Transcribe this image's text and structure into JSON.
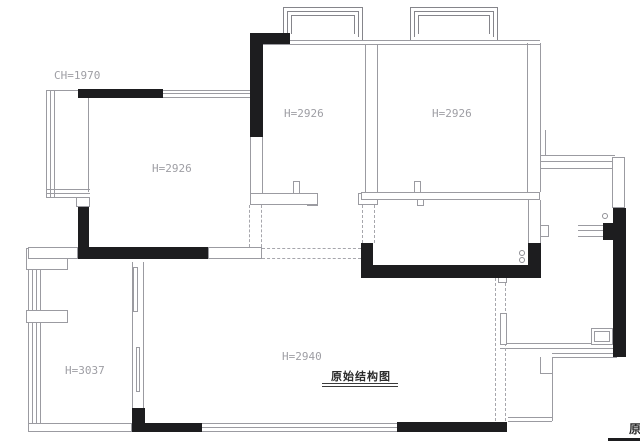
{
  "drawing": {
    "title": {
      "text": "原始结构图"
    },
    "clipped_title": {
      "text": "原"
    },
    "height_labels": [
      {
        "text": "CH=1970",
        "x": 54,
        "y": 69
      },
      {
        "text": "H=2926",
        "x": 152,
        "y": 162
      },
      {
        "text": "H=2926",
        "x": 284,
        "y": 107
      },
      {
        "text": "H=2926",
        "x": 432,
        "y": 107
      },
      {
        "text": "H=3037",
        "x": 65,
        "y": 364
      },
      {
        "text": "H=2940",
        "x": 282,
        "y": 350
      }
    ],
    "colors": {
      "wall_fill": "#1d1d1f",
      "thin_line": "#9b9ba1",
      "dashed_line": "#a6a6ac",
      "label_text": "#9e9ea4",
      "title_text": "#2b2b2b"
    }
  },
  "geometry": {
    "black_rects": [
      {
        "n": "wall-top-left",
        "x": 78,
        "y": 89,
        "w": 85,
        "h": 9
      },
      {
        "n": "wall-left-vertical",
        "x": 78,
        "y": 207,
        "w": 11,
        "h": 52
      },
      {
        "n": "wall-living-bottom",
        "x": 78,
        "y": 247,
        "w": 130,
        "h": 12
      },
      {
        "n": "wall-bed2-top",
        "x": 250,
        "y": 33,
        "w": 40,
        "h": 11
      },
      {
        "n": "wall-bed2-left",
        "x": 250,
        "y": 33,
        "w": 13,
        "h": 104
      },
      {
        "n": "wall-kitchen-left",
        "x": 361,
        "y": 243,
        "w": 12,
        "h": 35
      },
      {
        "n": "wall-kitchen-bottom",
        "x": 361,
        "y": 265,
        "w": 180,
        "h": 13
      },
      {
        "n": "wall-kitchen-right",
        "x": 528,
        "y": 243,
        "w": 13,
        "h": 35
      },
      {
        "n": "wall-right-exterior",
        "x": 613,
        "y": 208,
        "w": 13,
        "h": 149
      },
      {
        "n": "wall-right-corner",
        "x": 603,
        "y": 223,
        "w": 12,
        "h": 17
      },
      {
        "n": "wall-bottom-left-vertical",
        "x": 132,
        "y": 408,
        "w": 13,
        "h": 24
      },
      {
        "n": "wall-bottom-left",
        "x": 132,
        "y": 423,
        "w": 70,
        "h": 9
      },
      {
        "n": "wall-bottom-right",
        "x": 397,
        "y": 422,
        "w": 110,
        "h": 10
      }
    ],
    "outline_rects": [
      {
        "n": "opening-living-bottom",
        "x": 208,
        "y": 247,
        "w": 54,
        "h": 12
      },
      {
        "n": "wall-segment-left",
        "x": 76,
        "y": 197,
        "w": 14,
        "h": 10
      },
      {
        "n": "fixture-left-upper",
        "x": 26,
        "y": 248,
        "w": 42,
        "h": 22
      },
      {
        "n": "fixture-left-lower",
        "x": 26,
        "y": 310,
        "w": 42,
        "h": 13
      },
      {
        "n": "entry-door-leaf",
        "x": 591,
        "y": 328,
        "w": 22,
        "h": 17
      },
      {
        "n": "entry-door-leaf-inner",
        "x": 594,
        "y": 331,
        "w": 16,
        "h": 11
      },
      {
        "n": "wall-notch-kitchen",
        "x": 498,
        "y": 277,
        "w": 9,
        "h": 6
      },
      {
        "n": "door-jamb-dining",
        "x": 500,
        "y": 313,
        "w": 7,
        "h": 32
      },
      {
        "n": "pier-right-side",
        "x": 540,
        "y": 225,
        "w": 9,
        "h": 12
      },
      {
        "n": "wall-notch-bed2",
        "x": 307,
        "y": 197,
        "w": 11,
        "h": 9
      },
      {
        "n": "wall-notch-bed3",
        "x": 417,
        "y": 197,
        "w": 7,
        "h": 9
      },
      {
        "n": "pier-bed2",
        "x": 293,
        "y": 181,
        "w": 7,
        "h": 13
      },
      {
        "n": "pier-bed3",
        "x": 414,
        "y": 181,
        "w": 7,
        "h": 13
      },
      {
        "n": "wall-bed2-bottom",
        "x": 250,
        "y": 193,
        "w": 68,
        "h": 12
      },
      {
        "n": "wall-bed2-bottom-right",
        "x": 358,
        "y": 193,
        "w": 20,
        "h": 12
      },
      {
        "n": "wall-bed3-bottom",
        "x": 361,
        "y": 192,
        "w": 179,
        "h": 8
      },
      {
        "n": "wall-bottom-left-outline",
        "x": 28,
        "y": 423,
        "w": 104,
        "h": 9
      },
      {
        "n": "wall-left-top-outline",
        "x": 28,
        "y": 247,
        "w": 50,
        "h": 12
      },
      {
        "n": "wall-right-side-outline",
        "x": 612,
        "y": 157,
        "w": 13,
        "h": 51
      },
      {
        "n": "door-panel-upper",
        "x": 133,
        "y": 267,
        "w": 5,
        "h": 45
      },
      {
        "n": "door-panel-lower",
        "x": 136,
        "y": 347,
        "w": 4,
        "h": 45
      }
    ],
    "bays": [
      {
        "n": "bay-window-1-outer",
        "x": 283,
        "y": 7,
        "w": 80,
        "h": 33
      },
      {
        "n": "bay-window-1-mid",
        "x": 287,
        "y": 11,
        "w": 72,
        "h": 26
      },
      {
        "n": "bay-window-1-inner",
        "x": 291,
        "y": 15,
        "w": 64,
        "h": 19
      },
      {
        "n": "bay-window-2-outer",
        "x": 410,
        "y": 7,
        "w": 88,
        "h": 33
      },
      {
        "n": "bay-window-2-mid",
        "x": 414,
        "y": 11,
        "w": 80,
        "h": 26
      },
      {
        "n": "bay-window-2-inner",
        "x": 418,
        "y": 15,
        "w": 72,
        "h": 19
      }
    ],
    "hlines": [
      {
        "n": "wall-top-band-a",
        "x": 263,
        "y": 40,
        "len": 277
      },
      {
        "n": "wall-top-band-b",
        "x": 263,
        "y": 44,
        "len": 277
      },
      {
        "n": "window-living-top-a",
        "x": 163,
        "y": 90,
        "len": 87
      },
      {
        "n": "window-living-top-b",
        "x": 163,
        "y": 93,
        "len": 87
      },
      {
        "n": "window-living-top-c",
        "x": 163,
        "y": 97,
        "len": 87
      },
      {
        "n": "bay-left-top",
        "x": 46,
        "y": 90,
        "len": 32
      },
      {
        "n": "bay-left-bottom-a",
        "x": 46,
        "y": 189,
        "len": 44
      },
      {
        "n": "bay-left-bottom-b",
        "x": 46,
        "y": 193,
        "len": 44
      },
      {
        "n": "bay-left-bottom-c",
        "x": 46,
        "y": 197,
        "len": 44
      },
      {
        "n": "window-right-band-a",
        "x": 540,
        "y": 155,
        "len": 75
      },
      {
        "n": "window-right-band-b",
        "x": 540,
        "y": 161,
        "len": 75
      },
      {
        "n": "window-right-band-c",
        "x": 540,
        "y": 168,
        "len": 75
      },
      {
        "n": "window-right2-a",
        "x": 578,
        "y": 225,
        "len": 37
      },
      {
        "n": "window-right2-b",
        "x": 578,
        "y": 230,
        "len": 37
      },
      {
        "n": "window-right2-c",
        "x": 578,
        "y": 236,
        "len": 37
      },
      {
        "n": "window-bottom-a",
        "x": 202,
        "y": 423,
        "len": 195
      },
      {
        "n": "window-bottom-b",
        "x": 202,
        "y": 427,
        "len": 195
      },
      {
        "n": "window-bottom-c",
        "x": 202,
        "y": 431,
        "len": 195
      },
      {
        "n": "wall-step-a",
        "x": 500,
        "y": 343,
        "len": 113
      },
      {
        "n": "wall-step-b",
        "x": 500,
        "y": 348,
        "len": 113
      },
      {
        "n": "wall-step-outer-a",
        "x": 552,
        "y": 353,
        "len": 65
      },
      {
        "n": "wall-step-outer-b",
        "x": 552,
        "y": 357,
        "len": 65
      },
      {
        "n": "wall-step-bottom-a",
        "x": 508,
        "y": 417,
        "len": 44
      },
      {
        "n": "wall-step-bottom-b",
        "x": 508,
        "y": 421,
        "len": 44
      },
      {
        "n": "wall-step-tick",
        "x": 540,
        "y": 373,
        "len": 12
      }
    ],
    "vlines": [
      {
        "n": "bay-left-v1",
        "x": 46,
        "y": 90,
        "len": 107
      },
      {
        "n": "bay-left-v2",
        "x": 50,
        "y": 90,
        "len": 107
      },
      {
        "n": "bay-left-v3",
        "x": 54,
        "y": 90,
        "len": 107
      },
      {
        "n": "wall-living-left-edge",
        "x": 88,
        "y": 98,
        "len": 94
      },
      {
        "n": "wall-bed2-left-lower-a",
        "x": 250,
        "y": 137,
        "len": 68
      },
      {
        "n": "wall-bed2-left-lower-b",
        "x": 262,
        "y": 137,
        "len": 68
      },
      {
        "n": "wall-divider-a",
        "x": 365,
        "y": 44,
        "len": 149
      },
      {
        "n": "wall-divider-b",
        "x": 377,
        "y": 44,
        "len": 149
      },
      {
        "n": "wall-bed3-right-a",
        "x": 527,
        "y": 43,
        "len": 149
      },
      {
        "n": "wall-bed3-right-b",
        "x": 540,
        "y": 43,
        "len": 149
      },
      {
        "n": "wall-kitchen-upper-a",
        "x": 528,
        "y": 200,
        "len": 43
      },
      {
        "n": "wall-kitchen-upper-b",
        "x": 540,
        "y": 200,
        "len": 43
      },
      {
        "n": "wall-right-stub",
        "x": 545,
        "y": 130,
        "len": 25
      },
      {
        "n": "wall-left-outer",
        "x": 28,
        "y": 248,
        "len": 184
      },
      {
        "n": "wall-left-inner",
        "x": 32,
        "y": 258,
        "len": 165
      },
      {
        "n": "wall-left-dbl-a",
        "x": 36,
        "y": 270,
        "len": 153
      },
      {
        "n": "wall-left-dbl-b",
        "x": 40,
        "y": 270,
        "len": 153
      },
      {
        "n": "wall-interior-a",
        "x": 132,
        "y": 262,
        "len": 146
      },
      {
        "n": "wall-interior-b",
        "x": 143,
        "y": 262,
        "len": 158
      },
      {
        "n": "wall-step-v",
        "x": 552,
        "y": 357,
        "len": 64
      },
      {
        "n": "wall-step-v2",
        "x": 540,
        "y": 357,
        "len": 16
      }
    ],
    "dashed": [
      {
        "n": "dashed-bed2-left-a",
        "o": "v",
        "x": 249,
        "y": 205,
        "len": 42
      },
      {
        "n": "dashed-bed2-left-b",
        "o": "v",
        "x": 261,
        "y": 205,
        "len": 42
      },
      {
        "n": "dashed-hall-a",
        "o": "v",
        "x": 362,
        "y": 205,
        "len": 38
      },
      {
        "n": "dashed-hall-b",
        "o": "v",
        "x": 374,
        "y": 205,
        "len": 38
      },
      {
        "n": "dashed-corridor-a",
        "o": "h",
        "x": 262,
        "y": 248,
        "len": 99
      },
      {
        "n": "dashed-corridor-b",
        "o": "h",
        "x": 262,
        "y": 258,
        "len": 99
      },
      {
        "n": "dashed-dining-right-a",
        "o": "v",
        "x": 495,
        "y": 278,
        "len": 143
      },
      {
        "n": "dashed-dining-right-b",
        "o": "v",
        "x": 505,
        "y": 278,
        "len": 143
      }
    ],
    "circles": [
      {
        "n": "pipe-circle",
        "x": 519,
        "y": 250,
        "d": 6
      },
      {
        "n": "pipe-circle",
        "x": 519,
        "y": 257,
        "d": 6
      },
      {
        "n": "pipe-circle",
        "x": 602,
        "y": 213,
        "d": 6
      }
    ]
  }
}
